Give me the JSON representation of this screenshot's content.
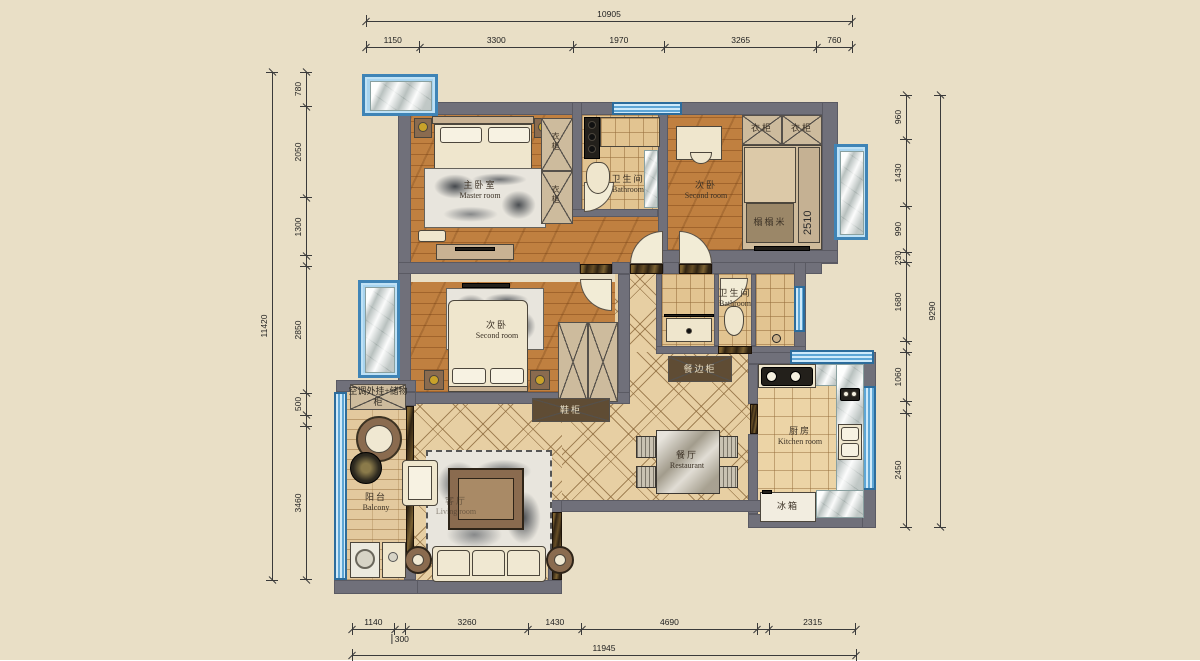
{
  "labels": {
    "master_cn": "主卧室",
    "master_en": "Master room",
    "bath_cn": "卫生间",
    "bath_en": "Bathroom",
    "second_cn": "次卧",
    "second_en": "Second room",
    "kitchen_cn": "厨房",
    "kitchen_en": "Kitchen room",
    "dining_cn": "餐厅",
    "dining_en": "Restaurant",
    "balcony_cn": "阳台",
    "balcony_en": "Balcony",
    "living_cn": "客厅",
    "living_en": "Living room",
    "wardrobe": "衣柜",
    "tatami": "榻榻米",
    "tatami_dim": "2510",
    "fridge": "冰箱",
    "sideboard": "餐边柜",
    "shoe_cabinet": "鞋柜",
    "balcony_note": "空调外挂+储物柜"
  },
  "dimensions": {
    "top": {
      "total": "10905",
      "segments": [
        {
          "v": 1150,
          "label": "1150"
        },
        {
          "v": 3300,
          "label": "3300"
        },
        {
          "v": 1970,
          "label": "1970"
        },
        {
          "v": 3265,
          "label": "3265"
        },
        {
          "v": 760,
          "label": "760"
        }
      ]
    },
    "left": {
      "total": "11420",
      "segments": [
        {
          "v": 780,
          "label": "780"
        },
        {
          "v": 2050,
          "label": "2050"
        },
        {
          "v": 1300,
          "label": "1300"
        },
        {
          "v": 240,
          "label": ""
        },
        {
          "v": 2850,
          "label": "2850"
        },
        {
          "v": 500,
          "label": "500"
        },
        {
          "v": 240,
          "label": ""
        },
        {
          "v": 3460,
          "label": "3460"
        }
      ]
    },
    "right": {
      "total": "9290",
      "segments": [
        {
          "v": 960,
          "label": "960"
        },
        {
          "v": 1430,
          "label": "1430"
        },
        {
          "v": 990,
          "label": "990"
        },
        {
          "v": 230,
          "label": "230"
        },
        {
          "v": 1680,
          "label": "1680"
        },
        {
          "v": 245,
          "label": ""
        },
        {
          "v": 1060,
          "label": "1060"
        },
        {
          "v": 245,
          "label": ""
        },
        {
          "v": 2450,
          "label": "2450"
        }
      ]
    },
    "bottom": {
      "total": "11945",
      "segments": [
        {
          "v": 1140,
          "label": "1140"
        },
        {
          "v": 300,
          "label": "300",
          "below": true
        },
        {
          "v": 3260,
          "label": "3260"
        },
        {
          "v": 1430,
          "label": "1430"
        },
        {
          "v": 4690,
          "label": "4690"
        },
        {
          "v": 320,
          "label": ""
        },
        {
          "v": 2315,
          "label": "2315"
        }
      ]
    }
  },
  "colors": {
    "background": "#e9dfc6",
    "wall": "#70707a",
    "window_blue": "#74b9e4",
    "wood_floor": "#c08040",
    "tile_floor": "#e7cfa3",
    "marble": "#dde2e0",
    "dark_marble": "#2f2313"
  }
}
